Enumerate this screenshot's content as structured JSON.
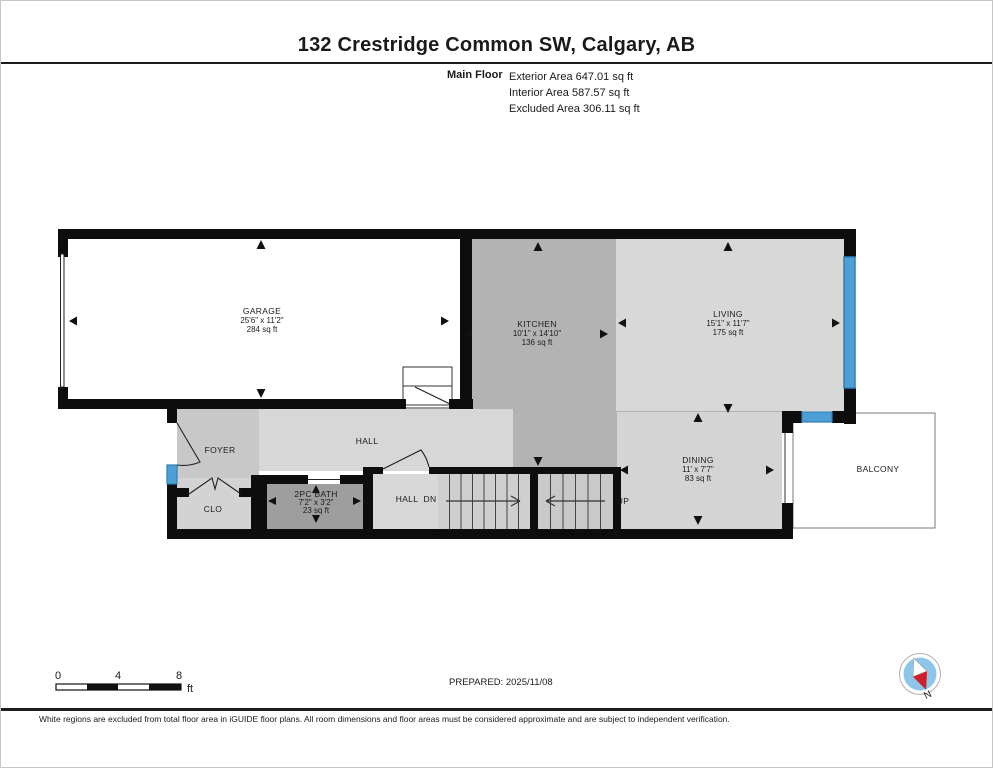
{
  "header": {
    "title": "132 Crestridge Common SW, Calgary, AB",
    "floor_label": "Main Floor",
    "exterior_area": "Exterior Area 647.01 sq ft",
    "interior_area": "Interior Area 587.57 sq ft",
    "excluded_area": "Excluded Area 306.11 sq ft"
  },
  "rooms": {
    "garage": {
      "name": "GARAGE",
      "dims": "25'6\" x 11'2\"",
      "area": "284 sq ft"
    },
    "kitchen": {
      "name": "KITCHEN",
      "dims": "10'1\" x 14'10\"",
      "area": "136 sq ft"
    },
    "living": {
      "name": "LIVING",
      "dims": "15'1\" x 11'7\"",
      "area": "175 sq ft"
    },
    "dining": {
      "name": "DINING",
      "dims": "11' x 7'7\"",
      "area": "83 sq ft"
    },
    "bath": {
      "name": "2PC BATH",
      "dims": "7'2\" x 3'2\"",
      "area": "23 sq ft"
    },
    "foyer": {
      "name": "FOYER"
    },
    "hall": {
      "name": "HALL"
    },
    "hall_lower": {
      "name": "HALL"
    },
    "closet": {
      "name": "CLO"
    },
    "balcony": {
      "name": "BALCONY"
    }
  },
  "stairs": {
    "down_label": "DN",
    "up_label": "UP"
  },
  "scale_bar": {
    "tick_0": "0",
    "tick_4": "4",
    "tick_8": "8",
    "unit": "ft"
  },
  "compass": {
    "north_label": "N"
  },
  "footer": {
    "prepared": "PREPARED: 2025/11/08",
    "disclaimer": "White regions are excluded from total floor area in iGUIDE floor plans. All room dimensions and floor areas must be considered approximate and are subject to independent verification."
  },
  "colors": {
    "wall": "#0d0d0d",
    "window_blue": "#4d9fd6",
    "excluded_white": "#ffffff",
    "kitchen_fill": "#b3b3b3",
    "living_fill": "#d8d8d8",
    "dining_fill": "#d4d4d4",
    "hall_fill": "#d7d7d7",
    "foyer_fill": "#c8c8c8",
    "bath_fill": "#9e9e9e",
    "closet_fill": "#d3d3d3",
    "stair_fill": "#cdcdcd",
    "compass_blue": "#8ec6ea",
    "compass_red": "#cf2027"
  }
}
